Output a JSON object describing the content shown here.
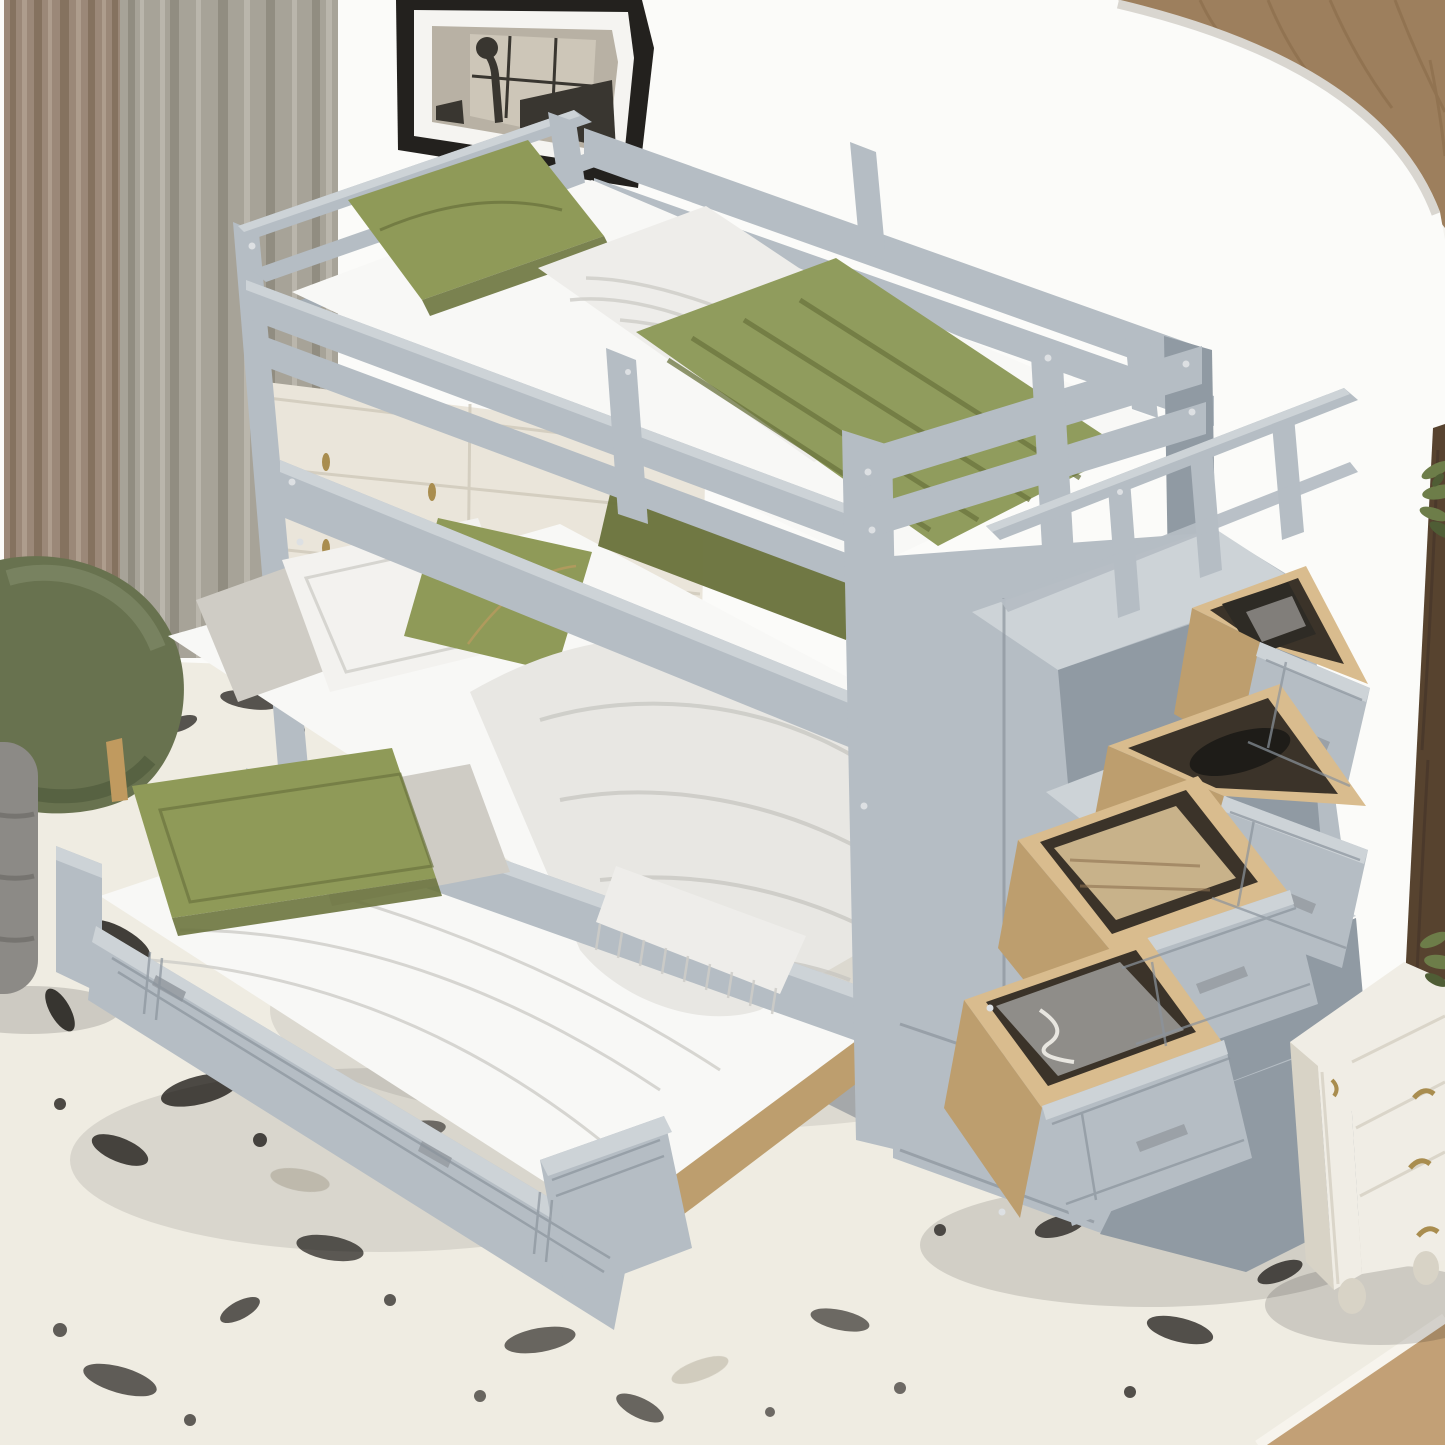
{
  "palette": {
    "wall": "#f3f2ee",
    "wall_bright": "#fbfbf9",
    "wall_rim": "#d9d6d0",
    "oak": "#9d7f5d",
    "oak_dark": "#876947",
    "walnut": "#57432f",
    "walnut_dark": "#42332a",
    "curtain_taupe": "#9b8878",
    "curtain_taupe_dark": "#85725f",
    "curtain_taupe_light": "#ae9d8d",
    "curtain_sheer": "#a7a398",
    "curtain_sheer_dark": "#918d81",
    "curtain_sheer_light": "#bab6ac",
    "frame_black": "#23211e",
    "frame_mat": "#f5f4f1",
    "art_bg": "#b8b1a4",
    "art_window": "#cdc6b8",
    "art_dark": "#393630",
    "dresser": "#eae5da",
    "dresser_shadow": "#cfc9ba",
    "brass": "#a98d4f",
    "gray_top": "#cdd3d7",
    "gray_face": "#b5bdc4",
    "gray_edge": "#a3acb4",
    "gray_side": "#909aa3",
    "gray_deep": "#6e7883",
    "routing": "#8b949d",
    "screw": "#dde0e3",
    "metal": "#9ba1a7",
    "mattress": "#f8f8f6",
    "sheet": "#eeedea",
    "sheet_shadow": "#cecdc8",
    "duvet": "#e8e7e3",
    "duvet_shadow": "#c5c4bf",
    "pillow_white": "#f3f2ef",
    "pillow_gray": "#cfccc5",
    "green": "#8f9a58",
    "green_light": "#a9b26e",
    "green_dark": "#6b743e",
    "green_blanket": "#909c5d",
    "gold": "#b49a5e",
    "pine": "#d9bc8e",
    "pine_dark": "#bd9e6e",
    "pine_deep": "#8d7250",
    "interior": "#3b3329",
    "item_black": "#1e1c18",
    "item_dark": "#2e2b25",
    "item_tan": "#c8b28a",
    "item_gray": "#8f8d89",
    "string_white": "#e8e6e0",
    "rug": "#efece2",
    "rug_edge": "#f7f4ed",
    "speckle": "#161310",
    "speckle_soft": "#b3ac9b",
    "floor": "#c2a076",
    "chair": "#68724f",
    "chair_light": "#7e8865",
    "chair_dark": "#505b3d",
    "wood_leg": "#c09a5f",
    "pouf": "#8c8a86",
    "pouf_dark": "#716f6b",
    "nightstand": "#f0ede5",
    "nightstand_shadow": "#d8d3c6",
    "plant": "#6d7d49",
    "plant_dark": "#4f5d35",
    "shadow": "#000000"
  },
  "scene": {
    "room": "kids bedroom product photo",
    "wall": {
      "style": "white curved accent wall",
      "corner": "oak wood paneling",
      "right_edge": "dark walnut wardrobe"
    },
    "curtains": {
      "left": "taupe drape",
      "right": "greige sheer drape"
    },
    "picture": {
      "frame": "black",
      "mat": "white",
      "art": "desk lamp by a window"
    },
    "dresser": {
      "color": "antique white",
      "handles": "brass teardrop pulls",
      "drawers": 3
    },
    "armchair": {
      "color": "olive green herringbone",
      "leg": "natural wood"
    },
    "ottoman": {
      "color": "gray ribbed"
    },
    "rug": {
      "style": "distressed marble speckle",
      "base": "ivory",
      "speckle": "black"
    },
    "bunk_bed": {
      "finish": "gray painted wood",
      "top_bunk": {
        "mattress": "white",
        "pillow": "olive green",
        "sheet": "white",
        "blanket": "olive green",
        "guardrails": 2
      },
      "bottom_bunk": {
        "mattress": "white",
        "pillows": [
          "white",
          "white",
          "olive green accent with gold stitching"
        ],
        "duvet": "white",
        "throw": "white fringed"
      },
      "trundle": {
        "state": "pulled out",
        "pillows": [
          "olive green",
          "light gray"
        ],
        "handles": 2,
        "detail": "routed double-line panels"
      },
      "staircase": {
        "railing": true,
        "steps": 3,
        "drawer_boxes": "natural pine",
        "drawer_handles": "brushed metal bars",
        "storage_drawers": [
          {
            "position": 1,
            "state": "open",
            "contents": "books and magazine"
          },
          {
            "position": 2,
            "state": "open",
            "contents": "black slipper and book"
          },
          {
            "position": 3,
            "state": "open",
            "contents": "folded beige knit sweater"
          },
          {
            "position": 4,
            "state": "open",
            "contents": "gray cushion with drawstring"
          }
        ]
      }
    },
    "nightstand": {
      "color": "antique white",
      "drawers": 3,
      "handles": "ornate brass",
      "feet": "bun"
    },
    "plant": "green houseplant sprigs",
    "floor": "natural wood corner"
  }
}
